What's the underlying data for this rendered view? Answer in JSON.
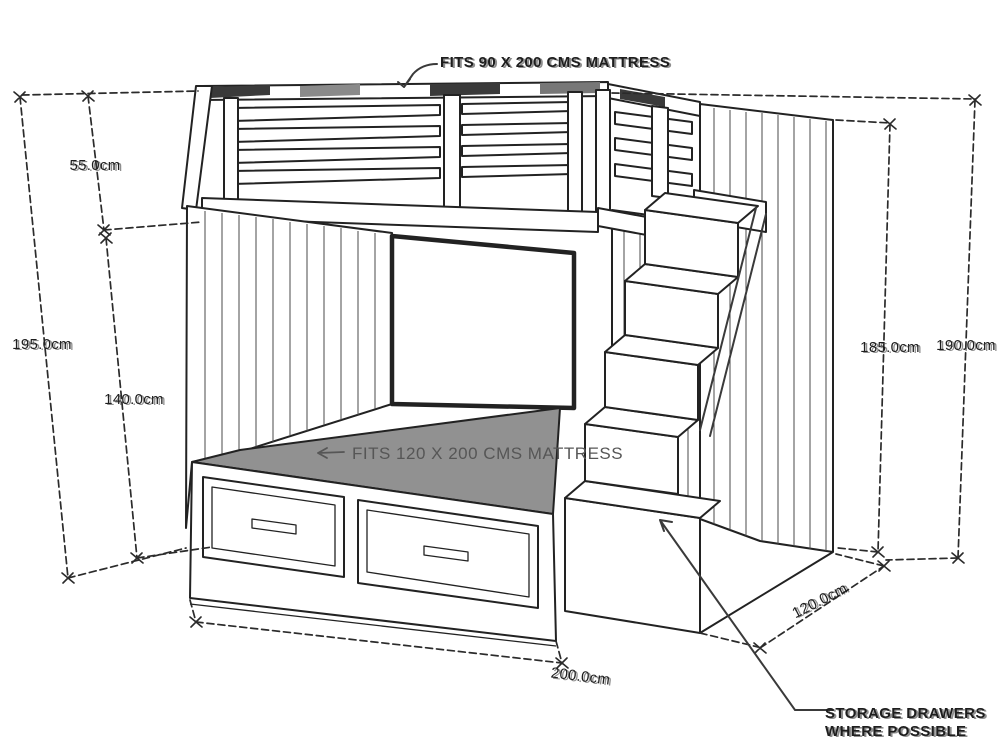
{
  "annotations": {
    "top_mattress_note": "FITS 90 X 200 CMS MATTRESS",
    "bottom_mattress_note": "FITS 120 X 200 CMS MATTRESS",
    "storage_note_line1": "STORAGE DRAWERS",
    "storage_note_line2": "WHERE POSSIBLE"
  },
  "dimensions": {
    "rail_section_height": "55.0cm",
    "overall_height_left": "195.0cm",
    "under_bunk_height": "140.0cm",
    "stair_side_height": "185.0cm",
    "overall_height_right": "190.0cm",
    "length": "200.0cm",
    "depth": "120.0cm"
  },
  "colors": {
    "background": "#ffffff",
    "line": "#222222",
    "dim_line": "#2b2b2b",
    "mattress_gray": "#919191",
    "label_gray": "#565656",
    "text_dark": "#1e1e1e"
  }
}
